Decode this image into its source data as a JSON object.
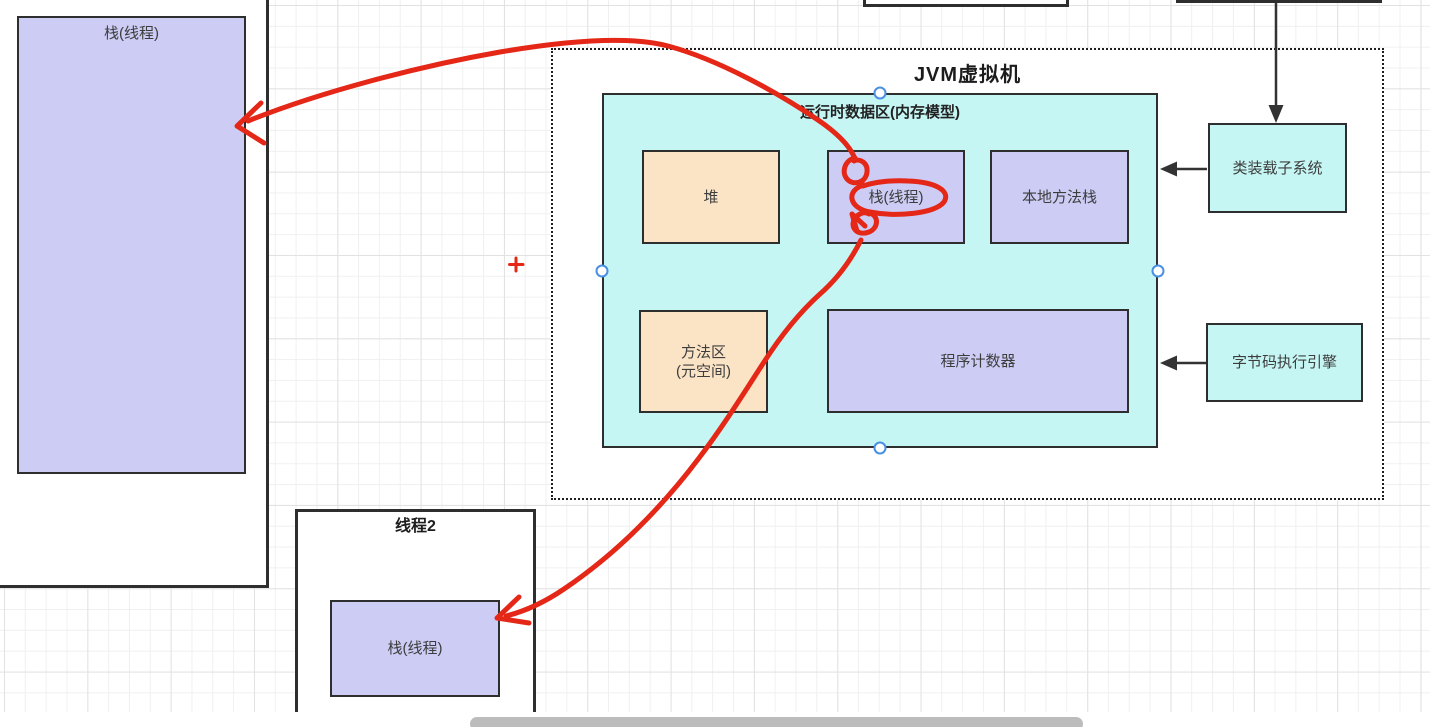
{
  "app": {
    "type": "diagram-editor-canvas",
    "grid_minor_px": 21,
    "grid_major_px": 83
  },
  "colors": {
    "purple_fill": "#ccccf4",
    "orange_fill": "#fbe4c6",
    "cyan_fill": "#c5f6f4",
    "shape_border": "#2e2e2e",
    "red_annotation": "#e52717",
    "selection_handle": "#4a90e2",
    "scrollbar": "#bcbcbc"
  },
  "left_thread_container": {
    "stack_label": "栈(线程)"
  },
  "jvm": {
    "title": "JVM虚拟机"
  },
  "runtime": {
    "title": "运行时数据区(内存模型)",
    "heap_label": "堆",
    "stack_label": "栈(线程)",
    "native_stack_label": "本地方法栈",
    "method_area_line1": "方法区",
    "method_area_line2": "(元空间)",
    "pc_label": "程序计数器"
  },
  "subsystems": {
    "class_loader_label": "类装载子系统",
    "exec_engine_label": "字节码执行引擎"
  },
  "thread2": {
    "title": "线程2",
    "stack_label": "栈(线程)"
  }
}
